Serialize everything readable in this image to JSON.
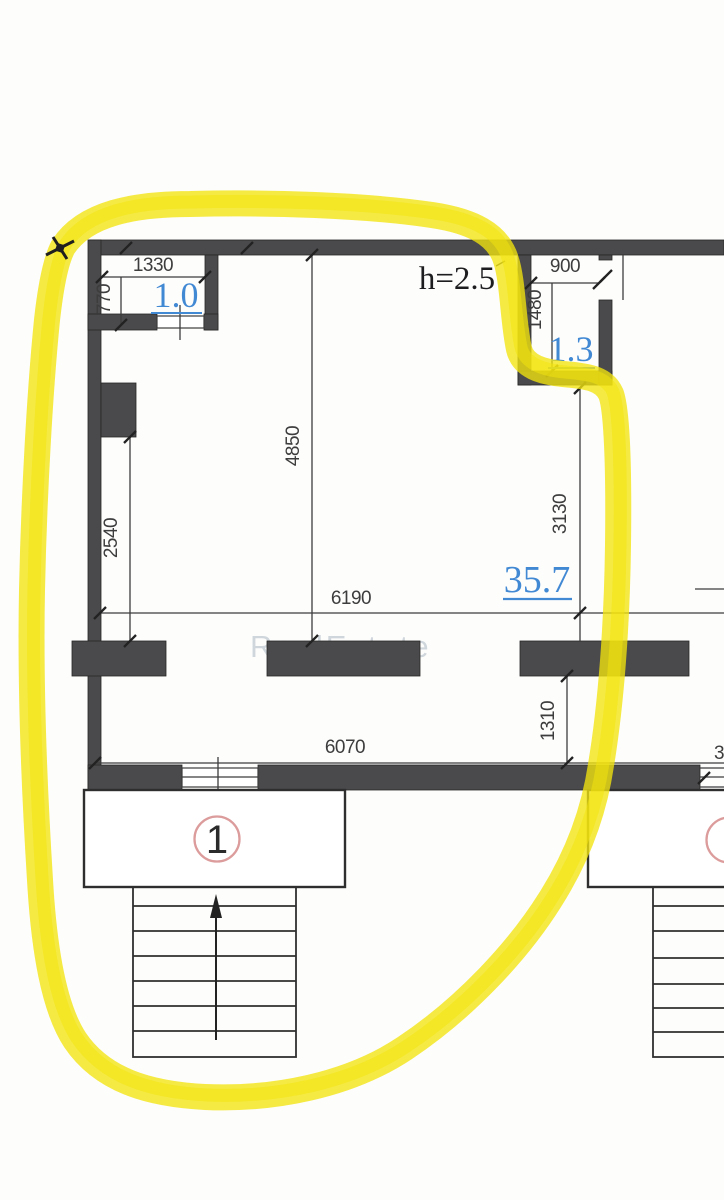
{
  "plan": {
    "ceiling_height": "h=2.5",
    "watermark": "RealEstate",
    "entrance": {
      "number": "1"
    },
    "neighbor": {
      "partial_dimension": "3"
    },
    "rooms": [
      {
        "id": "vestibule",
        "area_sqm": "1.0"
      },
      {
        "id": "bathroom",
        "area_sqm": "1.3"
      },
      {
        "id": "main-room",
        "area_sqm": "35.7"
      }
    ],
    "dimensions_mm": {
      "d1330": "1330",
      "d770": "770",
      "d900": "900",
      "d1480": "1480",
      "d4850": "4850",
      "d2540": "2540",
      "d6190": "6190",
      "d3130": "3130",
      "d1310": "1310",
      "d6070": "6070"
    }
  },
  "colors": {
    "wall": "#4a4a4c",
    "line": "#3c3c3c",
    "area_label_blue": "#4289d4",
    "highlighter_yellow": "#f2e40e",
    "entrance_circle_red": "#dc9c9c",
    "watermark_gray": "#8fa0ae"
  }
}
